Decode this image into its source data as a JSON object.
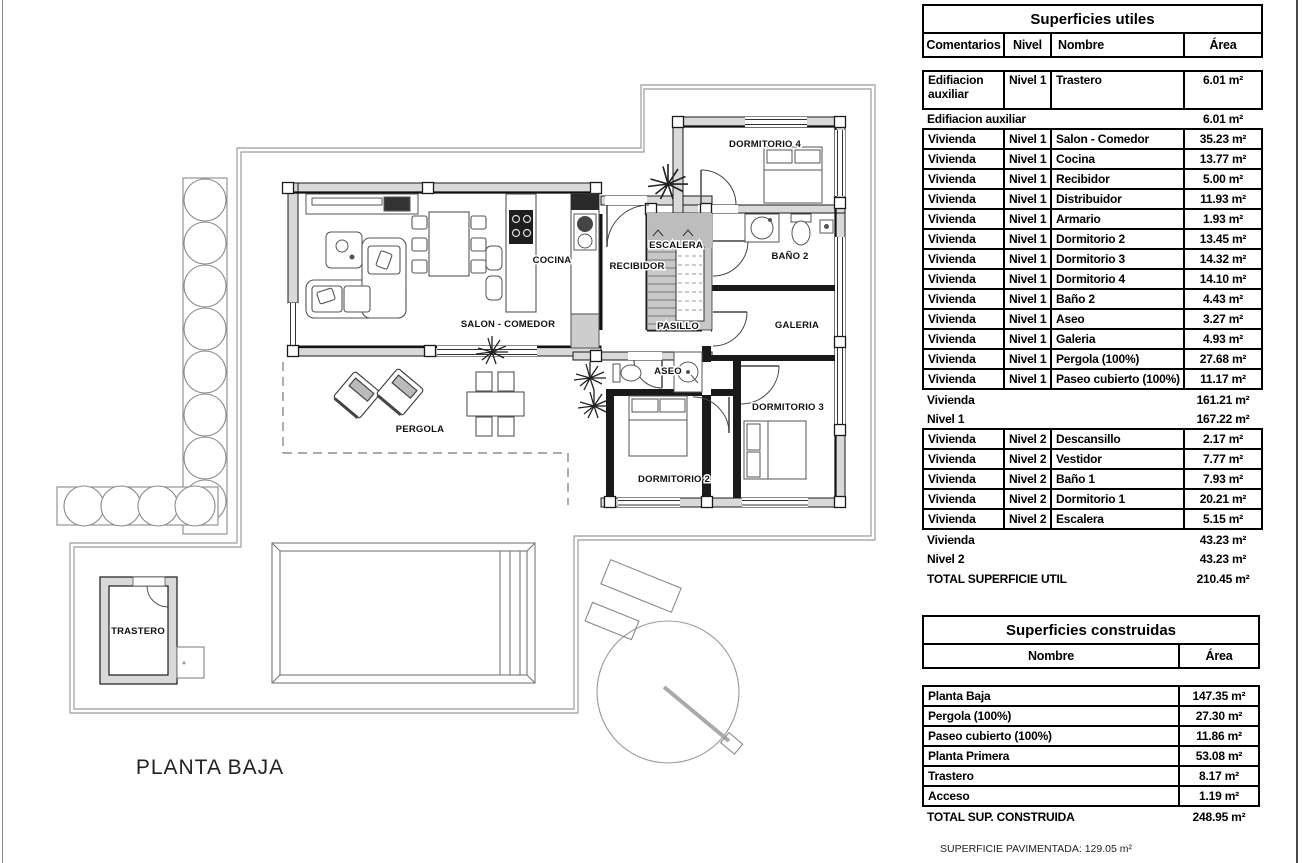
{
  "plan": {
    "title": "PLANTA BAJA",
    "labels": {
      "salon": "SALON - COMEDOR",
      "cocina": "COCINA",
      "recibidor": "RECIBIDOR",
      "escalera": "ESCALERA",
      "pasillo": "PASILLO",
      "aseo": "ASEO",
      "bano2": "BAÑO 2",
      "galeria": "GALERIA",
      "dormitorio2": "DORMITORIO 2",
      "dormitorio3": "DORMITORIO 3",
      "dormitorio4": "DORMITORIO 4",
      "pergola": "PERGOLA",
      "trastero": "TRASTERO"
    }
  },
  "tables": {
    "utiles": {
      "title": "Superficies utiles",
      "columns": [
        "Comentarios",
        "Nivel",
        "Nombre",
        "Área"
      ],
      "rows": [
        {
          "type": "data",
          "cells": [
            "Edifiacion auxiliar",
            "Nivel 1",
            "Trastero",
            "6.01 m²"
          ]
        },
        {
          "type": "summary",
          "label": "Edifiacion auxiliar",
          "area": "6.01 m²"
        },
        {
          "type": "data",
          "cells": [
            "Vivienda",
            "Nivel 1",
            "Salon - Comedor",
            "35.23 m²"
          ]
        },
        {
          "type": "data",
          "cells": [
            "Vivienda",
            "Nivel 1",
            "Cocina",
            "13.77 m²"
          ]
        },
        {
          "type": "data",
          "cells": [
            "Vivienda",
            "Nivel 1",
            "Recibidor",
            "5.00 m²"
          ]
        },
        {
          "type": "data",
          "cells": [
            "Vivienda",
            "Nivel 1",
            "Distribuidor",
            "11.93 m²"
          ]
        },
        {
          "type": "data",
          "cells": [
            "Vivienda",
            "Nivel 1",
            "Armario",
            "1.93 m²"
          ]
        },
        {
          "type": "data",
          "cells": [
            "Vivienda",
            "Nivel 1",
            "Dormitorio 2",
            "13.45 m²"
          ]
        },
        {
          "type": "data",
          "cells": [
            "Vivienda",
            "Nivel 1",
            "Dormitorio 3",
            "14.32 m²"
          ]
        },
        {
          "type": "data",
          "cells": [
            "Vivienda",
            "Nivel 1",
            "Dormitorio 4",
            "14.10 m²"
          ]
        },
        {
          "type": "data",
          "cells": [
            "Vivienda",
            "Nivel 1",
            "Baño 2",
            "4.43 m²"
          ]
        },
        {
          "type": "data",
          "cells": [
            "Vivienda",
            "Nivel 1",
            "Aseo",
            "3.27 m²"
          ]
        },
        {
          "type": "data",
          "cells": [
            "Vivienda",
            "Nivel 1",
            "Galeria",
            "4.93 m²"
          ]
        },
        {
          "type": "data",
          "cells": [
            "Vivienda",
            "Nivel 1",
            "Pergola (100%)",
            "27.68 m²"
          ]
        },
        {
          "type": "data",
          "cells": [
            "Vivienda",
            "Nivel 1",
            "Paseo cubierto (100%)",
            "11.17 m²"
          ]
        },
        {
          "type": "summary",
          "label": "Vivienda",
          "area": "161.21 m²"
        },
        {
          "type": "summary",
          "label": "Nivel 1",
          "area": "167.22 m²"
        },
        {
          "type": "data",
          "cells": [
            "Vivienda",
            "Nivel 2",
            "Descansillo",
            "2.17 m²"
          ]
        },
        {
          "type": "data",
          "cells": [
            "Vivienda",
            "Nivel 2",
            "Vestidor",
            "7.77 m²"
          ]
        },
        {
          "type": "data",
          "cells": [
            "Vivienda",
            "Nivel 2",
            "Baño 1",
            "7.93 m²"
          ]
        },
        {
          "type": "data",
          "cells": [
            "Vivienda",
            "Nivel 2",
            "Dormitorio 1",
            "20.21 m²"
          ]
        },
        {
          "type": "data",
          "cells": [
            "Vivienda",
            "Nivel 2",
            "Escalera",
            "5.15 m²"
          ]
        },
        {
          "type": "summary",
          "label": "Vivienda",
          "area": "43.23 m²"
        },
        {
          "type": "summary",
          "label": "Nivel 2",
          "area": "43.23 m²"
        },
        {
          "type": "summary",
          "label": "TOTAL SUPERFICIE UTIL",
          "area": "210.45 m²"
        }
      ]
    },
    "construidas": {
      "title": "Superficies construidas",
      "columns": [
        "Nombre",
        "Área"
      ],
      "rows": [
        {
          "type": "data",
          "cells": [
            "Planta Baja",
            "147.35 m²"
          ]
        },
        {
          "type": "data",
          "cells": [
            "Pergola (100%)",
            "27.30 m²"
          ]
        },
        {
          "type": "data",
          "cells": [
            "Paseo cubierto (100%)",
            "11.86 m²"
          ]
        },
        {
          "type": "data",
          "cells": [
            "Planta Primera",
            "53.08 m²"
          ]
        },
        {
          "type": "data",
          "cells": [
            "Trastero",
            "8.17 m²"
          ]
        },
        {
          "type": "data",
          "cells": [
            "Acceso",
            "1.19 m²"
          ]
        },
        {
          "type": "summary",
          "label": "TOTAL SUP. CONSTRUIDA",
          "area": "248.95 m²"
        }
      ]
    }
  },
  "footer_note": "SUPERFICIE PAVIMENTADA: 129.05 m²"
}
